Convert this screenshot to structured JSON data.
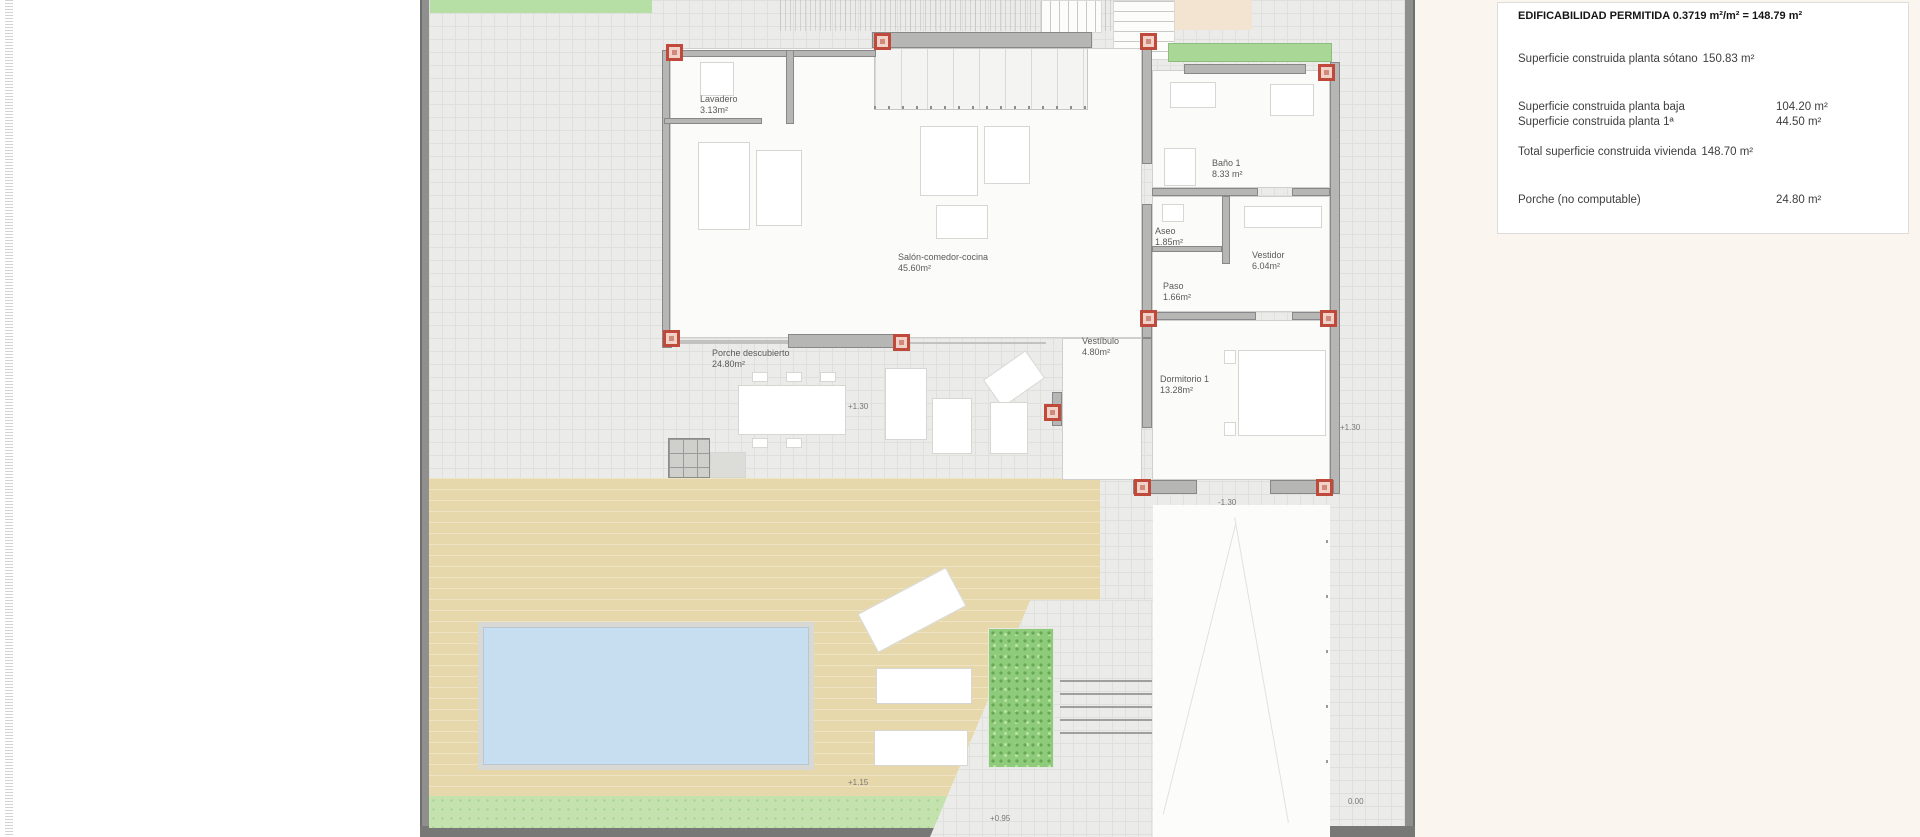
{
  "drawing": {
    "type": "floor-plan",
    "description": "Planta baja de vivienda unifamiliar con parcela, porche, piscina y acceso"
  },
  "info_panel": {
    "title": "EDIFICABILIDAD PERMITIDA 0.3719 m²/m² = 148.79 m²",
    "rows": [
      {
        "label": "Superficie construida planta sótano",
        "value": "150.83 m²"
      },
      {
        "label": "Superficie construida planta baja",
        "value": "104.20 m²"
      },
      {
        "label": "Superficie construida planta 1ª",
        "value": "44.50 m²"
      },
      {
        "label": "Total superficie construida vivienda",
        "value": "148.70 m²"
      },
      {
        "label": "Porche (no computable)",
        "value": "24.80 m²"
      }
    ]
  },
  "rooms": {
    "lavadero": {
      "name": "Lavadero",
      "area": "3.13m²"
    },
    "salon": {
      "name": "Salón-comedor-cocina",
      "area": "45.60m²"
    },
    "bano1": {
      "name": "Baño 1",
      "area": "8.33 m²"
    },
    "aseo": {
      "name": "Aseo",
      "area": "1.85m²"
    },
    "vestidor": {
      "name": "Vestidor",
      "area": "6.04m²"
    },
    "paso": {
      "name": "Paso",
      "area": "1.66m²"
    },
    "vestibulo": {
      "name": "Vestíbulo",
      "area": "4.80m²"
    },
    "dormitorio1": {
      "name": "Dormitorio 1",
      "area": "13.28m²"
    },
    "porche": {
      "name": "Porche descubierto",
      "area": "24.80m²"
    }
  },
  "levels": {
    "porch": "+1.30",
    "east_side": "+1.30",
    "entrance_court": "-1.30",
    "deck": "+1.15",
    "path": "+0.95",
    "gate": "0.00"
  },
  "colors": {
    "pillar_red": "#bf4a3c",
    "deck_tan": "#e7d8ab",
    "pool_blue": "#c7ddf0",
    "grass_green": "#c3e2ae",
    "hedge_green": "#8ecb7a",
    "wall_gray": "#b6b6b4",
    "paving_gray": "#ebebe9",
    "outside_cream": "#faf6ef"
  }
}
